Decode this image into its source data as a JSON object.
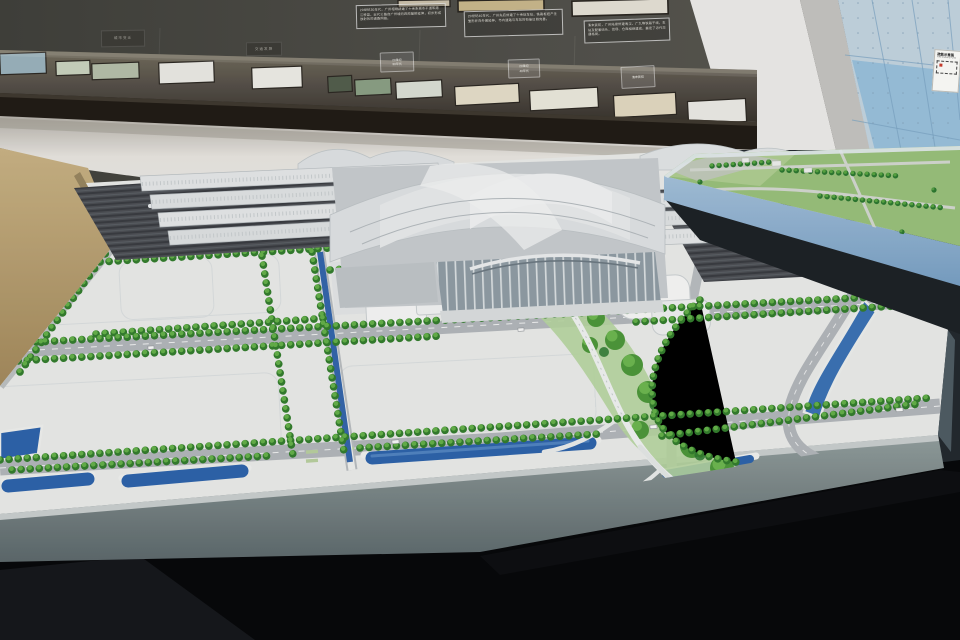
{
  "scene": {
    "description": "Museum exhibition hall: a large architectural scale model of a modern railway station district sits on a low black display table; a second green landscape model stands on a raised light-blue platform at the right; a dark wall case behind holds historical maps and documents with caption panels.",
    "primary_model": "railway station district scale model",
    "secondary_model": "landscape district scale model"
  },
  "wall_display": {
    "caption_panels": [
      {
        "text": "20世纪30年代，广州相继辟建了十余条城市干道和跨江桥梁，近代公路自广州城向四周辐射延伸，初步形成放射状的道路网络。"
      },
      {
        "text": "20世纪40年代，广州先后修建了十余处车站，铁路枢纽产生雏形并向外围延伸，市内道路与车站的衔接日趋完善。"
      },
      {
        "text": "清末民初，广州陆续修建粤汉、广九等铁路干线，车站及配套码头、货场、仓库相继建成，奠定了近代交通格局。"
      }
    ],
    "section_plaques": [
      {
        "label": "城市变迁"
      },
      {
        "label": "交通发展"
      }
    ],
    "period_labels": [
      {
        "line1": "20世纪",
        "line2": "30年代"
      },
      {
        "line1": "20世纪",
        "line2": "40年代"
      },
      {
        "line1": "清末民初",
        "line2": ""
      }
    ]
  },
  "signage": {
    "fire_plan_title": "疏散示意图",
    "fire_plan_subtitle": "FIRE ESCAPE PLAN"
  },
  "palette": {
    "wall": "#504f49",
    "case_wood": "#241f19",
    "floor_black": "#0a0b0d",
    "wood_floor": "#c0a97c",
    "table_top": "#f0f1ef",
    "table_side": "#7e8a8c",
    "water": "#3568ae",
    "tree_dark": "#35802f",
    "tree_light": "#67b44b",
    "glass_wall": "#a9cbe3",
    "right_model_side": "#93b7d8",
    "grass": "#9cc47e",
    "track": "#4e5156",
    "station_roof": "#e6e8ea"
  }
}
